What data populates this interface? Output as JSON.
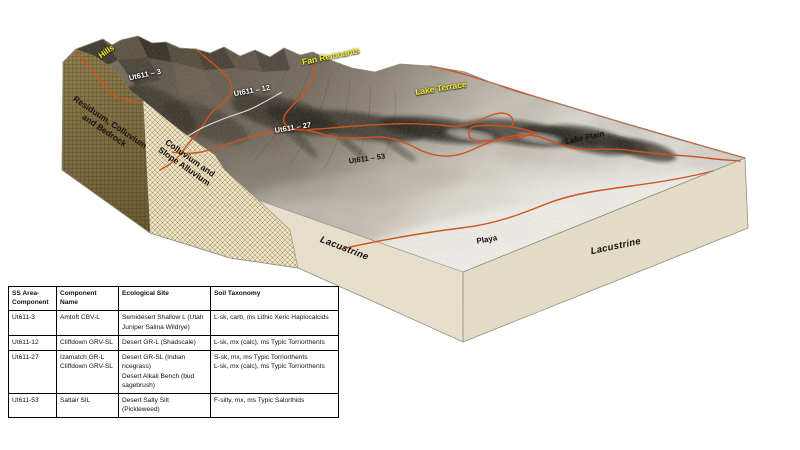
{
  "diagram": {
    "landform_labels": {
      "hills": "Hills",
      "fan_remnants": "Fan Remnants",
      "lake_terrace": "Lake Terrace",
      "lake_plain": "Lake Plain",
      "playa": "Playa",
      "lacustrine_front_left": "Lacustrine",
      "lacustrine_front_right": "Lacustrine"
    },
    "map_unit_labels": {
      "ut611_3": "Ut611 – 3",
      "ut611_12": "Ut611 – 12",
      "ut611_27": "Ut611 – 27",
      "ut611_53": "Ut611 – 53"
    },
    "cross_section_labels": {
      "residuum": "Residuum, Colluvium\nand Bedrock",
      "colluvium": "Colluvium and\nSlope Alluvium"
    },
    "colors": {
      "delineation_line": "#d0521d",
      "secondary_line": "#e3e0d8",
      "landform_label_yellow": "#f0ee22",
      "map_unit_label_white": "#ffffff",
      "left_face_olive": "#8d7c50",
      "front_face_cream": "#e8e1cd"
    }
  },
  "legend_table": {
    "headers": [
      "SS Area-\nComponent",
      "Component Name",
      "Ecological Site",
      "Soil Taxonomy"
    ],
    "rows": [
      [
        "Ut611-3",
        "Amtoft CBV-L",
        "Semidesert Shallow L (Utah\nJuniper Salina Wildrye)",
        "L-sk, carb, ms Lithic Xeric Haplocalcids"
      ],
      [
        "Ut611-12",
        "Cliffdown GRV-SL",
        "Desert GR-L (Shadscale)",
        "L-sk, mx (calc), ms Typic Torriorthents"
      ],
      [
        "Ut611-27",
        "Izamatch GR-L\nCliffdown GRV-SL",
        "Desert GR-SL (Indian ricegrass)\nDesert Alkali Bench (bud\nsagebrush)",
        "S-sk, mx, ms Typic Torriorthents\nL-sk, mx (calc), ms Typic Torriorthents"
      ],
      [
        "Ut611-53",
        "Saltair SIL",
        "Desert Salty Silt (Pickleweed)",
        "F-silty, mx, ms Typic Salorthids"
      ]
    ]
  }
}
